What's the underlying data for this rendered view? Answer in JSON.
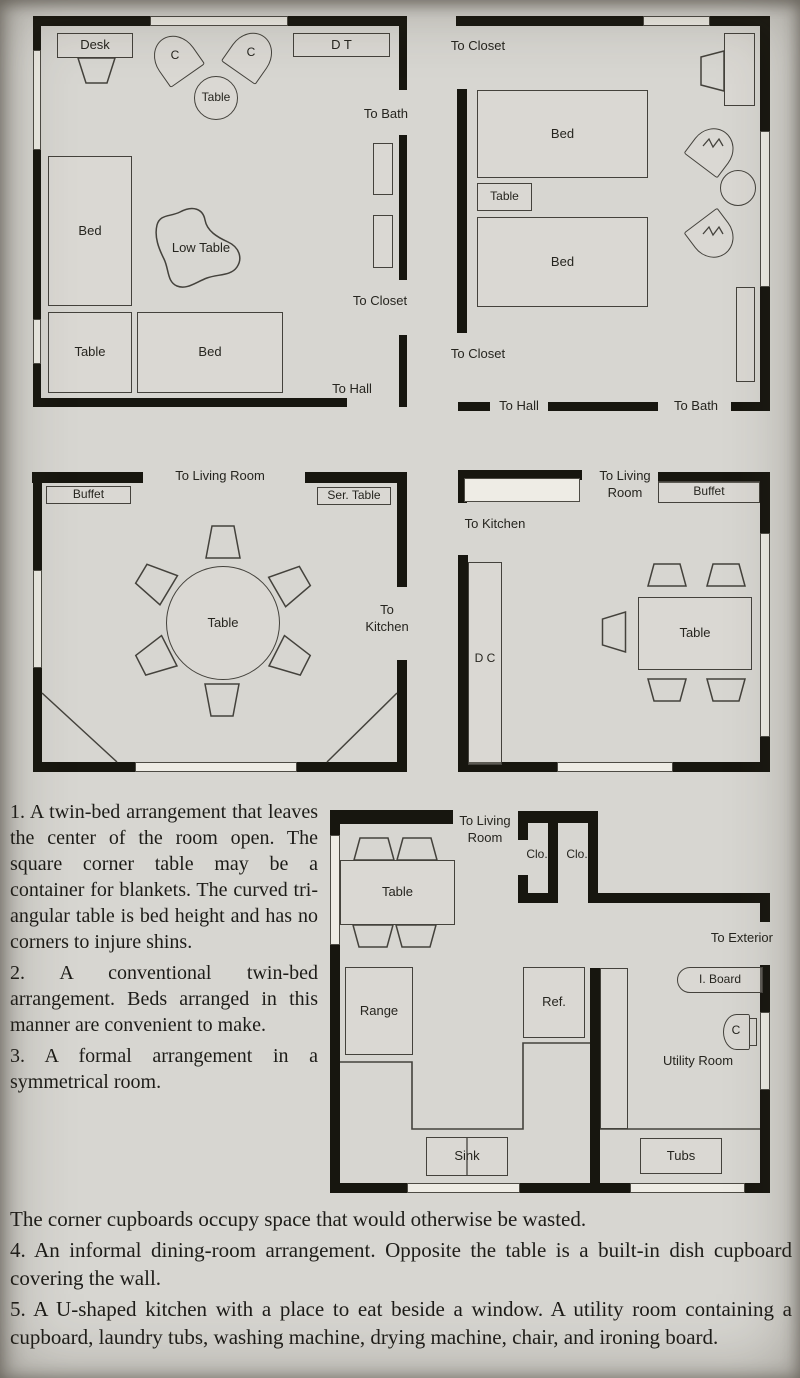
{
  "colors": {
    "page_bg": "#d7d6d1",
    "wall": "#17160f",
    "line": "#44423c",
    "text": "#1d1c18"
  },
  "figure": {
    "plan1": {
      "furniture": {
        "desk": "Desk",
        "chair_left": "C",
        "chair_right": "C",
        "round_table": "Table",
        "dressing_table": "D T",
        "bed_left": "Bed",
        "low_table": "Low Table",
        "corner_table": "Table",
        "bed_bottom": "Bed"
      },
      "doors": {
        "to_bath": "To Bath",
        "to_closet": "To Closet",
        "to_hall": "To Hall"
      }
    },
    "plan2": {
      "furniture": {
        "bed_top": "Bed",
        "table": "Table",
        "bed_bottom": "Bed"
      },
      "doors": {
        "to_closet_top": "To Closet",
        "to_closet_bottom": "To Closet",
        "to_hall": "To Hall",
        "to_bath": "To Bath"
      }
    },
    "plan3": {
      "furniture": {
        "buffet": "Buffet",
        "serving_table": "Ser. Table",
        "table": "Table"
      },
      "doors": {
        "to_living_room": "To Living Room",
        "to_kitchen": "To Kitchen"
      }
    },
    "plan4": {
      "furniture": {
        "buffet": "Buffet",
        "dish_cupboard": "D C",
        "table": "Table"
      },
      "doors": {
        "to_living_room": "To Living Room",
        "to_kitchen": "To Kitchen"
      }
    },
    "plan5": {
      "furniture": {
        "table": "Table",
        "range": "Range",
        "refrigerator": "Ref.",
        "sink": "Sink",
        "tubs": "Tubs",
        "ironing_board": "I. Board",
        "chair": "C",
        "closet_left": "Clo.",
        "closet_right": "Clo."
      },
      "rooms": {
        "utility_room": "Utility Room"
      },
      "doors": {
        "to_living_room": "To Living Room",
        "to_exterior": "To Exterior"
      }
    }
  },
  "captions": {
    "item1": "1. A twin-bed arrange­ment that leaves the cen­ter of the room open. The square corner table may be a container for blankets. The curved tri­angular table is bed height and has no corners to in­jure shins.",
    "item2": "2. A conventional twin-bed arrangement. Beds arranged in this manner are convenient to make.",
    "item3_part1": "3. A formal arrangement in a symmetrical room.",
    "item3_part2": "The corner cupboards occupy space that would otherwise be wasted.",
    "item4": "4. An informal dining-room arrangement. Opposite the table is a built-in dish cupboard covering the wall.",
    "item5": "5. A U-shaped kitchen with a place to eat beside a window. A utility room containing a cupboard, laundry tubs, washing machine, drying machine, chair, and ironing board."
  }
}
